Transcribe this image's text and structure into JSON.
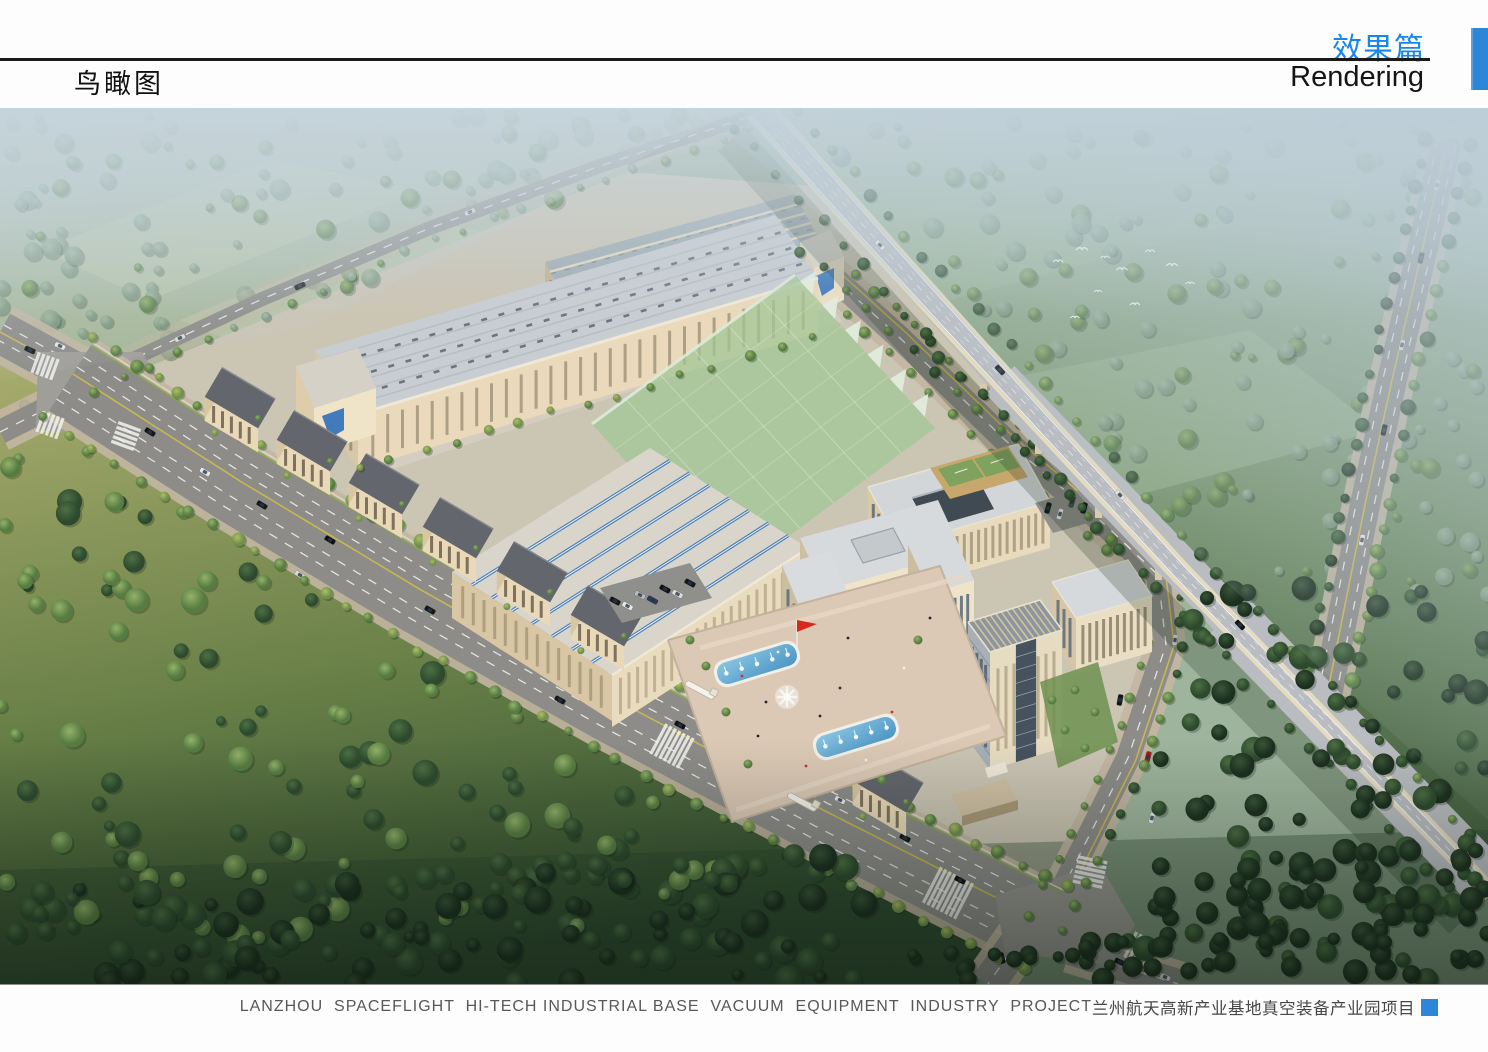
{
  "header": {
    "section_cn": "效果篇",
    "section_en": "Rendering",
    "page_title": "鸟瞰图",
    "accent_color": "#2e86d8",
    "section_cn_color": "#1987e8"
  },
  "caption": {
    "en": "LANZHOU  SPACEFLIGHT  HI-TECH INDUSTRIAL BASE  VACUUM  EQUIPMENT  INDUSTRY  PROJECT",
    "cn": "兰州航天高新产业基地真空装备产业园项目",
    "marker_color": "#2e86d8"
  },
  "artwork": {
    "type": "aerial-rendering",
    "subject": "Bird's-eye view rendering of an industrial park campus with factory halls, headquarters building, office tower, fountain plaza, green field, elevated expressway viaduct, tree-lined roads and surrounding forest",
    "palette": {
      "sky_haze": "#bccdd8",
      "field_olive": "#a9ac6e",
      "forest_dark": "#3a5538",
      "road_gray": "#8d8c88",
      "facade_cream": "#e9dcbe",
      "roof_solar_blue": "#4f82b8",
      "pool_blue": "#5fa8d5",
      "flag_red": "#d8281c"
    }
  }
}
